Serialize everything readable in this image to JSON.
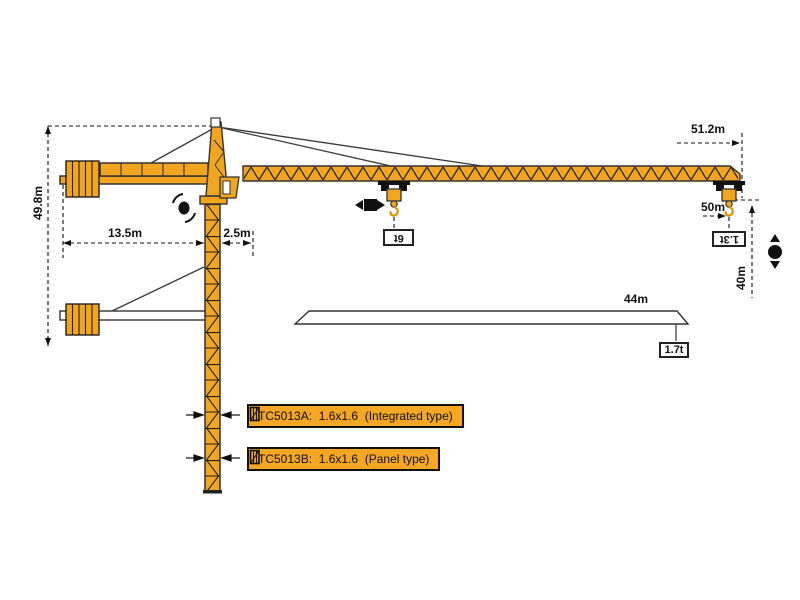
{
  "dimensions": {
    "total_height": "49.8m",
    "counter_jib_radius": "13.5m",
    "rear_offset": "2.5m",
    "max_working_radius": "51.2m",
    "main_jib_length": "50m",
    "hook_height": "40m",
    "short_jib_length": "44m"
  },
  "loads": {
    "max_capacity": "6t",
    "tip_load_50m_jib": "1.3t",
    "tip_load_44m_jib": "1.7t"
  },
  "variant_boxes": [
    {
      "label": "TC5013A:  1.6x1.6  (Integrated type)"
    },
    {
      "label": "TC5013B:  1.6x1.6  (Panel type)"
    }
  ],
  "colors": {
    "crane_orange": "#F2A51F",
    "variant_box_orange": "#F5A623",
    "outline": "#333333",
    "dimension_line": "#111111",
    "background": "#FFFFFF"
  },
  "icons": {
    "slewing": "slewing-rotation-icon",
    "trolley_travel": "trolley-travel-icon",
    "hoisting": "hoisting-up-down-icon",
    "mast_section": "mast-section-icon"
  }
}
